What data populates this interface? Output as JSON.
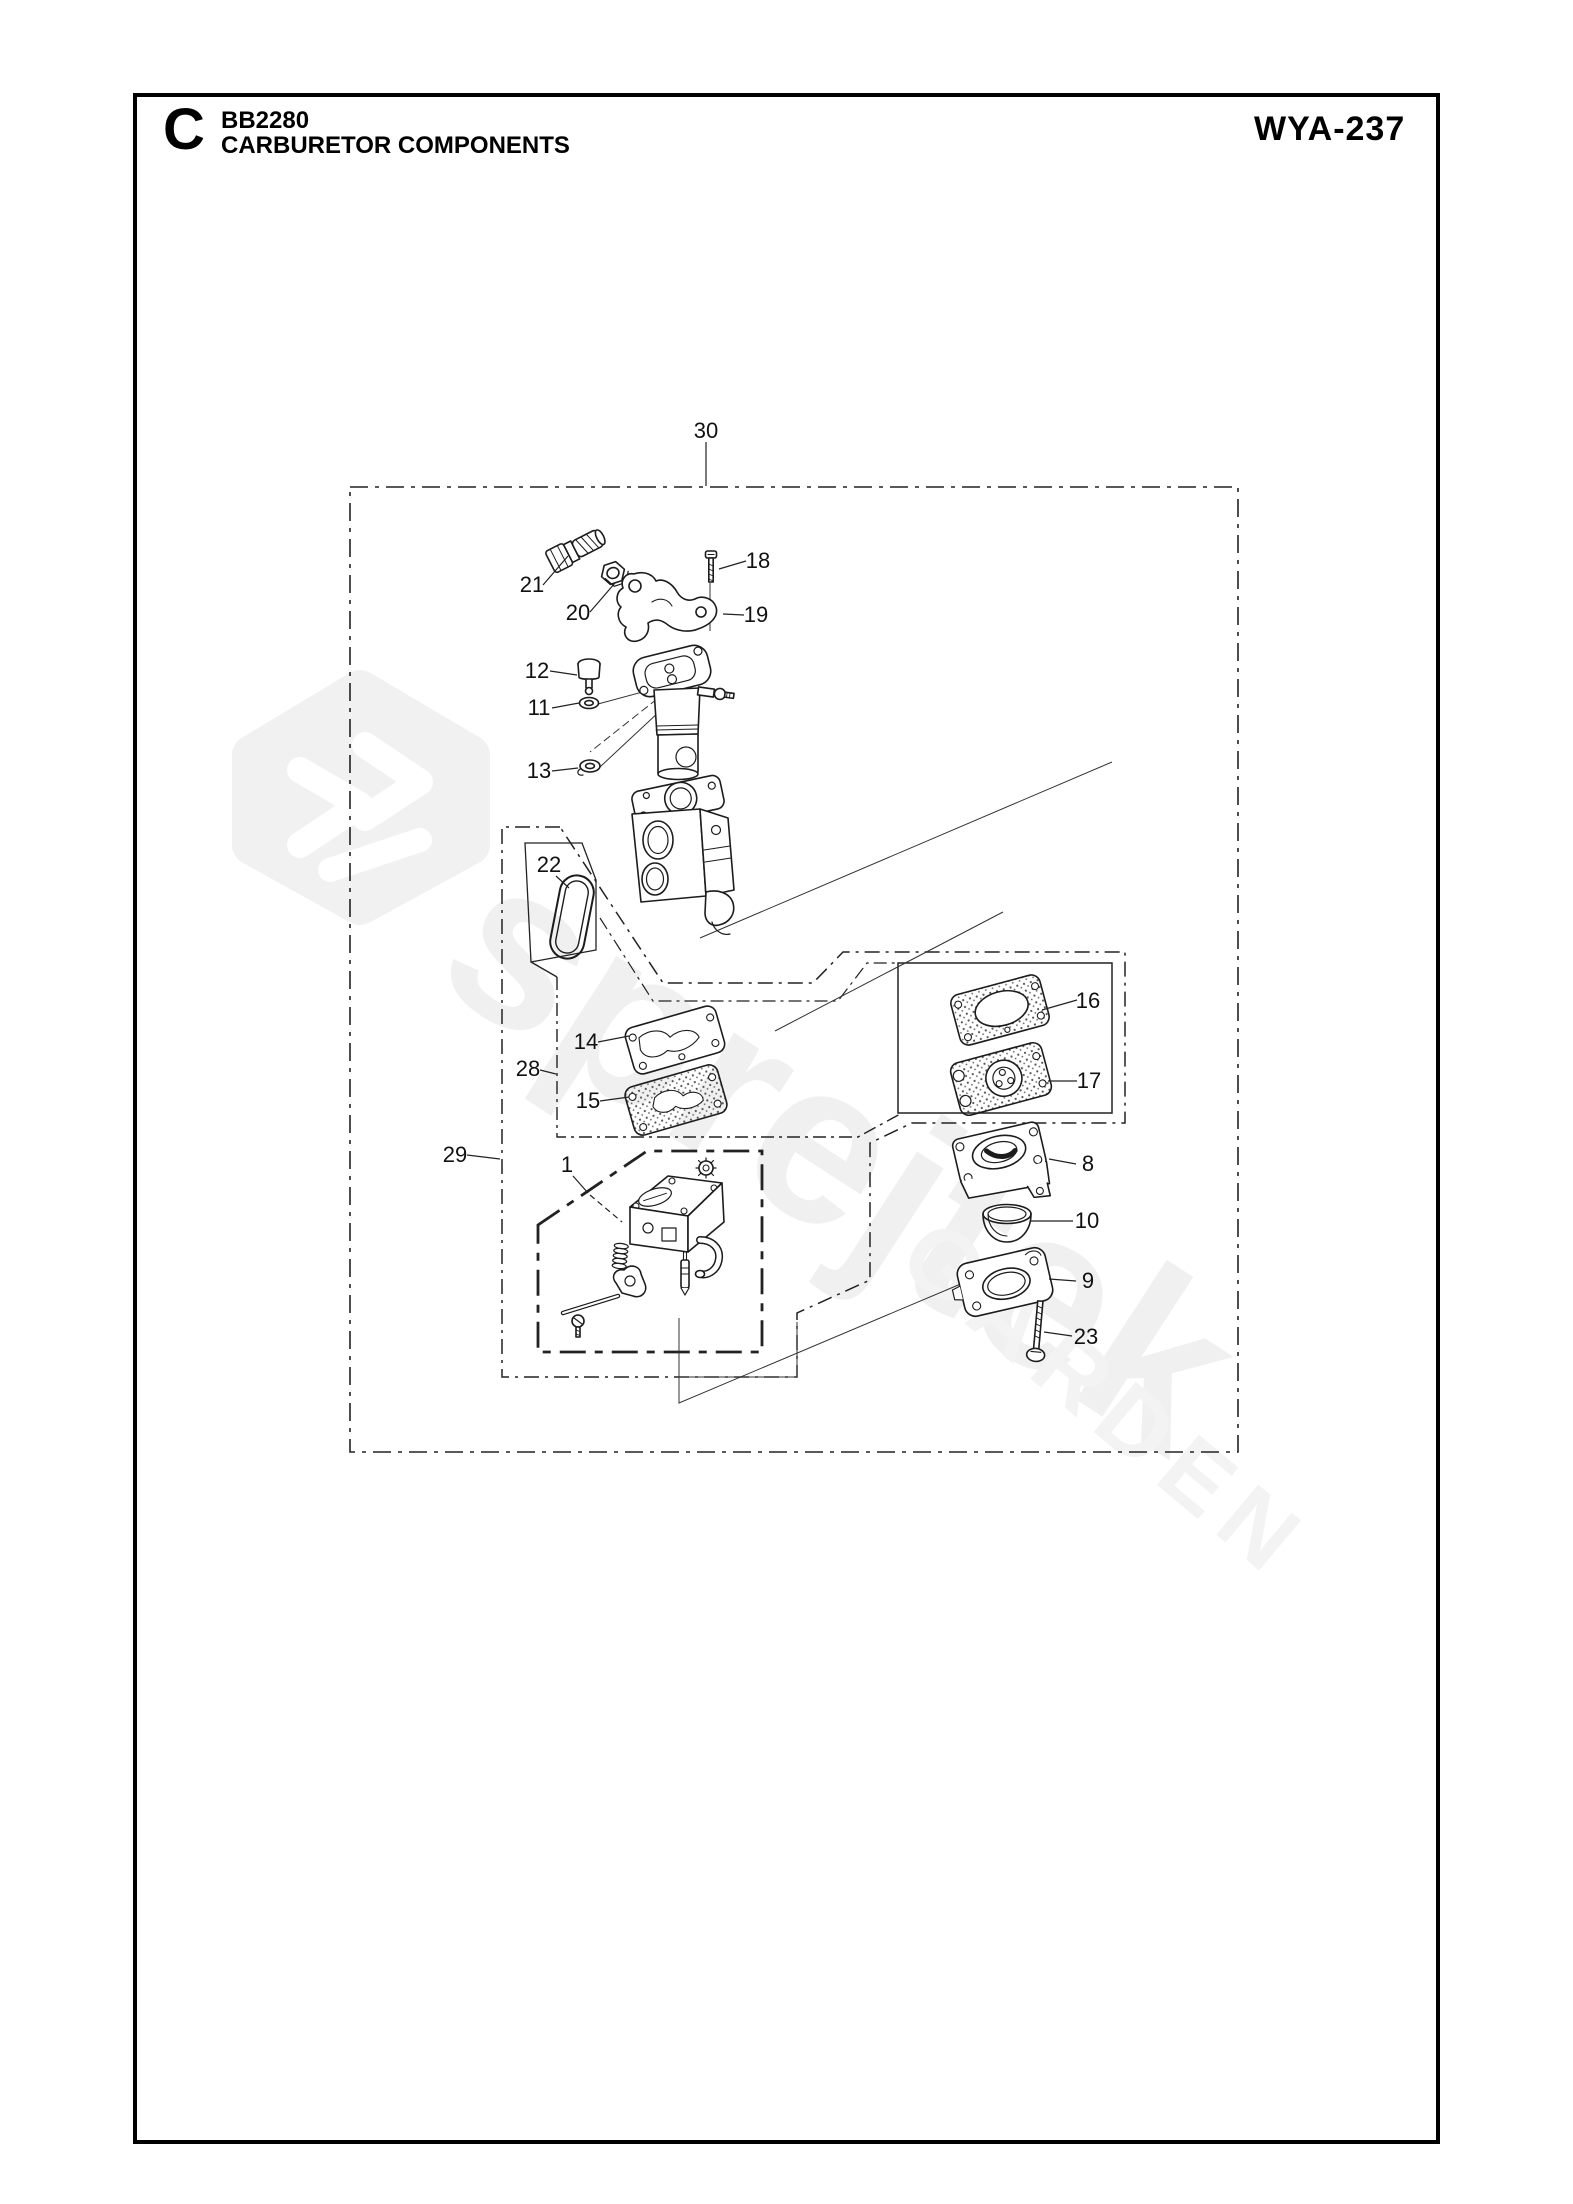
{
  "page": {
    "section_letter": "C",
    "model_code": "BB2280",
    "page_title": "CARBURETOR COMPONENTS",
    "diagram_ref": "WYA-237"
  },
  "watermark": {
    "brand": "sprejtek",
    "tagline": "GARDEN"
  },
  "callouts": {
    "c1": "1",
    "c8": "8",
    "c9": "9",
    "c10": "10",
    "c11": "11",
    "c12": "12",
    "c13": "13",
    "c14": "14",
    "c15": "15",
    "c16": "16",
    "c17": "17",
    "c18": "18",
    "c19": "19",
    "c20": "20",
    "c21": "21",
    "c22": "22",
    "c23": "23",
    "c28": "28",
    "c29": "29",
    "c30": "30"
  }
}
